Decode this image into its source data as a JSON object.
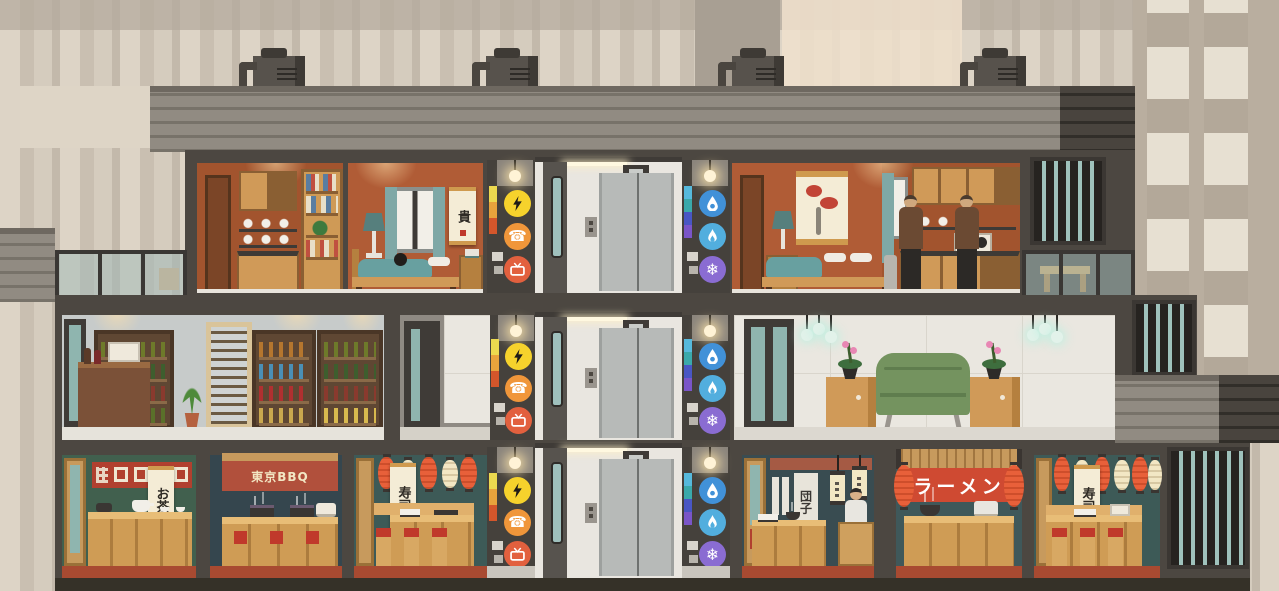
{
  "scene": {
    "description": "Cross-section of a downtown high-rise: apartments on the top floor, a wine shop and lounge on the middle floor, Japanese restaurants at street level",
    "floors": [
      {
        "level": 3,
        "rooms": [
          "apartment-left",
          "elevator",
          "apartment-right",
          "balcony-left",
          "balcony-right"
        ]
      },
      {
        "level": 2,
        "rooms": [
          "wine-shop",
          "hallway",
          "elevator",
          "lobby-lounge"
        ]
      },
      {
        "level": 1,
        "rooms": [
          "tea-house",
          "tokyo-bbq",
          "sushi-bar",
          "elevator",
          "dango-shop",
          "ramen-shop",
          "sushi-bar-2"
        ]
      }
    ]
  },
  "signs": {
    "tea_banner": "お茶",
    "bbq_awning": "東京BBQ",
    "sushi_banner_1": "寿司",
    "dango_sign": "団子",
    "ramen_sign": "ラーメン",
    "sushi_banner_2": "寿司",
    "bedroom_scroll": "貴"
  },
  "utilities": {
    "electric_shaft_icons": [
      "electricity",
      "phone",
      "cable-tv"
    ],
    "plumbing_shaft_icons": [
      "water",
      "gas",
      "hvac"
    ]
  },
  "colors": {
    "accent_electric": "#f6d22c",
    "accent_phone": "#f0963a",
    "accent_cable": "#e2603e",
    "accent_water": "#4191d8",
    "accent_gas": "#52aede",
    "accent_hvac": "#8a6cd2",
    "lantern_red": "#e8603a",
    "lantern_cream": "#f2e7c4",
    "sign_red": "#cf4a32",
    "awning_red": "#b1503c",
    "sofa_green": "#74935f",
    "apartment_wall": "#b05c36",
    "restaurant_wall_green": "#41604e",
    "building_frame": "#4c4741",
    "roof": "#8b857c"
  }
}
